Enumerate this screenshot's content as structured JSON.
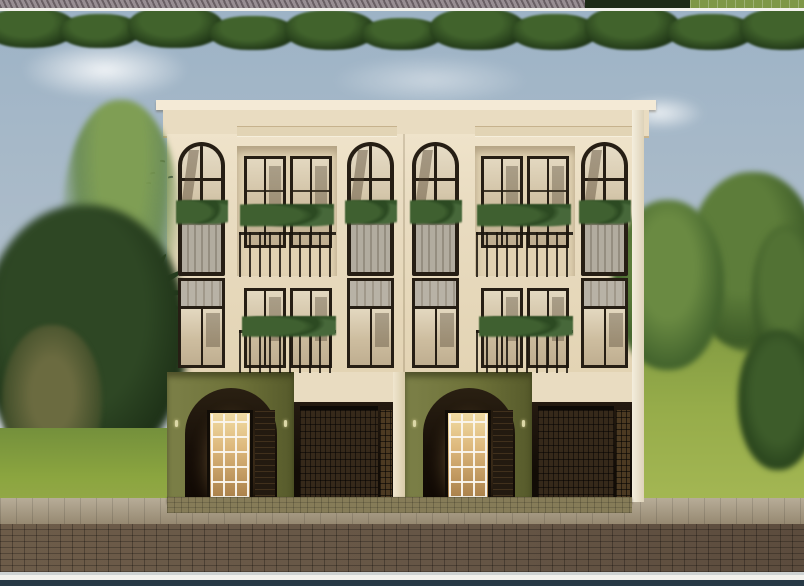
{
  "image_type": "architectural exterior rendering, no text or UI controls visible",
  "colors": {
    "sky-top": "#9db3c6",
    "sky-bot": "#c9cfd2",
    "cream": "#e9dcc1",
    "cream-hi": "#f4ead6",
    "frame": "#261e14",
    "louver": "#b2ac9f",
    "olive": "#6e7239",
    "lawn": "#a5b854",
    "walk": "#a3957b",
    "road": "#665646",
    "strip-white": "#f2f1ec",
    "strip-teal": "#273945"
  },
  "scene": {
    "building": {
      "floors": 3,
      "units": 2,
      "arched_windows_top_floor": 4,
      "balconies_with_plants": 4,
      "second_floor_windows": 8,
      "ground_floor_arched_entries": 2,
      "entry_glass_doors": 2,
      "garage_roller_doors": 2,
      "facade_finish": "cream plaster upper floors, olive green ground floor"
    },
    "vegetation": {
      "left_thin_palms": 2,
      "right_fan_palm": 1,
      "agave_plants": 3,
      "cycad_plants": 2,
      "tree_masses_left": 3,
      "tree_masses_right": 4,
      "front_hedge_row": 1
    },
    "environment": {
      "birds_in_sky": 5,
      "clouds": 3,
      "street": "brick paver road with sidewalk in front of building",
      "framing": "white border lines with dark teal strip at bottom and sliver of another rendering at top"
    }
  }
}
